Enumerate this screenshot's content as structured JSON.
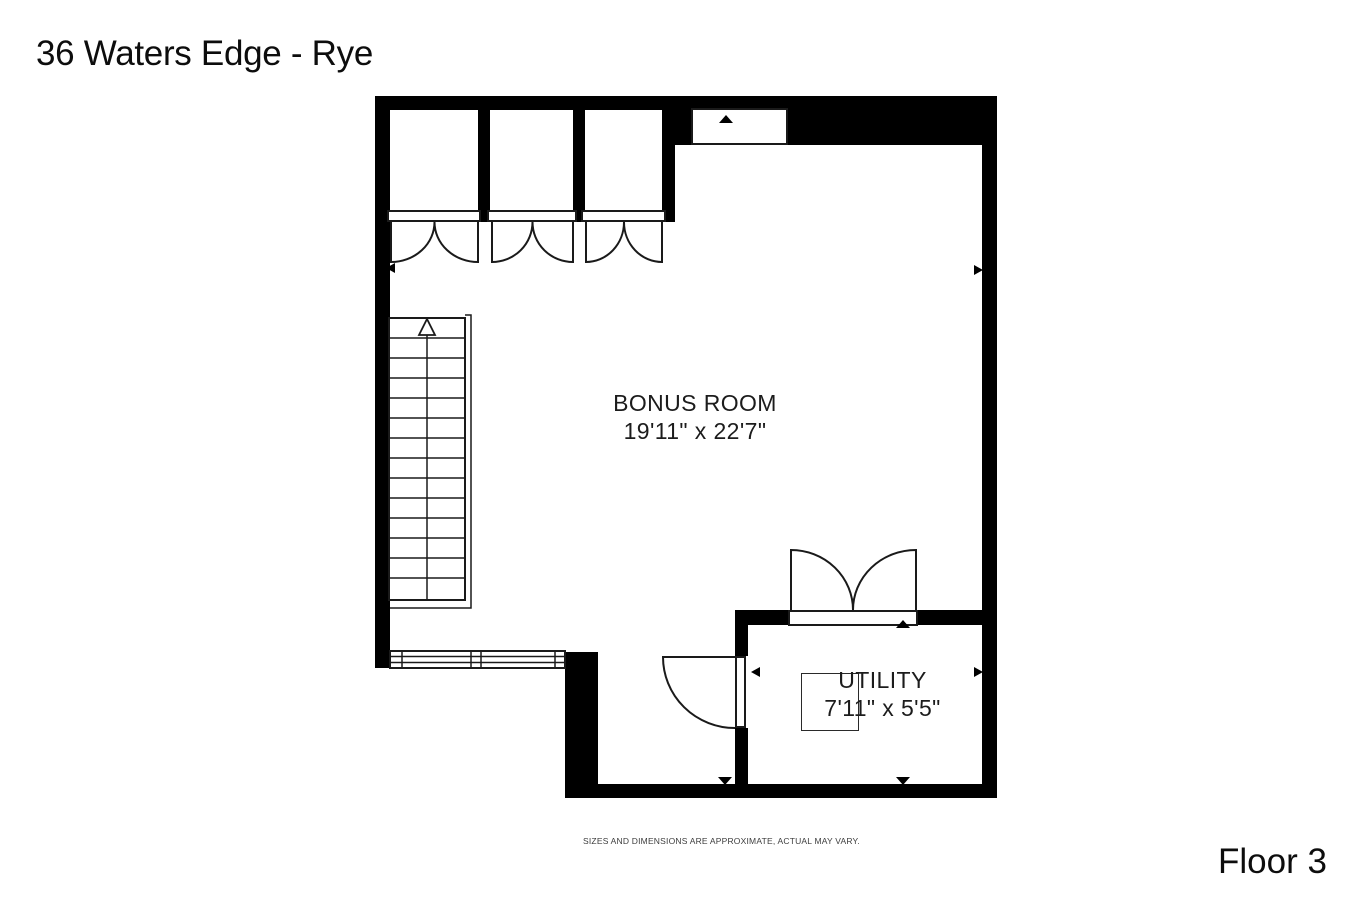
{
  "title": "36 Waters Edge - Rye",
  "floor_label": "Floor 3",
  "disclaimer": "SIZES AND DIMENSIONS ARE APPROXIMATE, ACTUAL MAY VARY.",
  "rooms": [
    {
      "name": "BONUS ROOM",
      "dimensions": "19'11\" x 22'7\""
    },
    {
      "name": "UTILITY",
      "dimensions": "7'11\" x 5'5\""
    }
  ],
  "symbols": {
    "stairs_direction": "up-arrow",
    "wall_marker": "small-black-triangle",
    "closet_doors": "double-swing",
    "utility_entry_doors": "double-swing",
    "utility_side_door": "single-swing",
    "window": "double-pane"
  },
  "colors": {
    "background": "#ffffff",
    "walls": "#000000",
    "lines": "#1a1a1a",
    "text": "#111111"
  }
}
